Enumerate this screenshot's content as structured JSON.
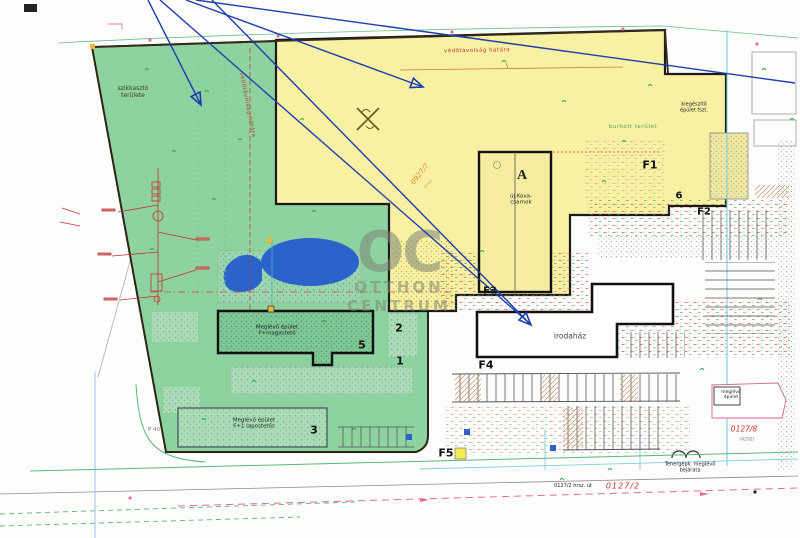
{
  "watermark": {
    "oc": "OC",
    "otthon": "OTTHON",
    "centrum": "CENTRUM"
  },
  "labels": {
    "infiltration": "szikkasztó\nterülete",
    "boundary_top": "védőtávolság határa",
    "boundary_side": "védőtávolság határa",
    "paved": "burkolt terület",
    "p40": "P 40",
    "entrance": "Tehergépk. meglévő\nbejárata",
    "parcel_yellow": "0927/7",
    "parcel_yellow_sub": "hrsz.",
    "parcel_road_red": "0127/2",
    "parcel_road_black": "0127/2 hrsz. út",
    "parcel_se": "0127/8",
    "parcel_se_sub": "(4292)"
  },
  "buildings": {
    "hall_mark": "A",
    "hall_name": "új Kova-\ncsarnok",
    "b5_name": "Meglévő épület\nF+magastető",
    "b3_name": "Meglévő épület\nF+1 lapostetős",
    "office_name": "irodaház",
    "annex_name": "kiegészítő\népület fszt.",
    "se_name": "meglévő\népület"
  },
  "markers": {
    "f1": "F1",
    "f2": "F2",
    "f3": "F3",
    "f4": "F4",
    "f5": "F5",
    "n1": "1",
    "n2": "2",
    "n3": "3",
    "n5": "5",
    "n6": "6"
  },
  "colors": {
    "site_green": "#8ed2a0",
    "site_yellow": "#f8f0a2",
    "pond_blue": "#2b62cc",
    "arrow_blue": "#1d3db0",
    "annotation_red": "#cc3333",
    "annotation_green": "#2fa34f",
    "watermark_gray": "#7d8574"
  }
}
